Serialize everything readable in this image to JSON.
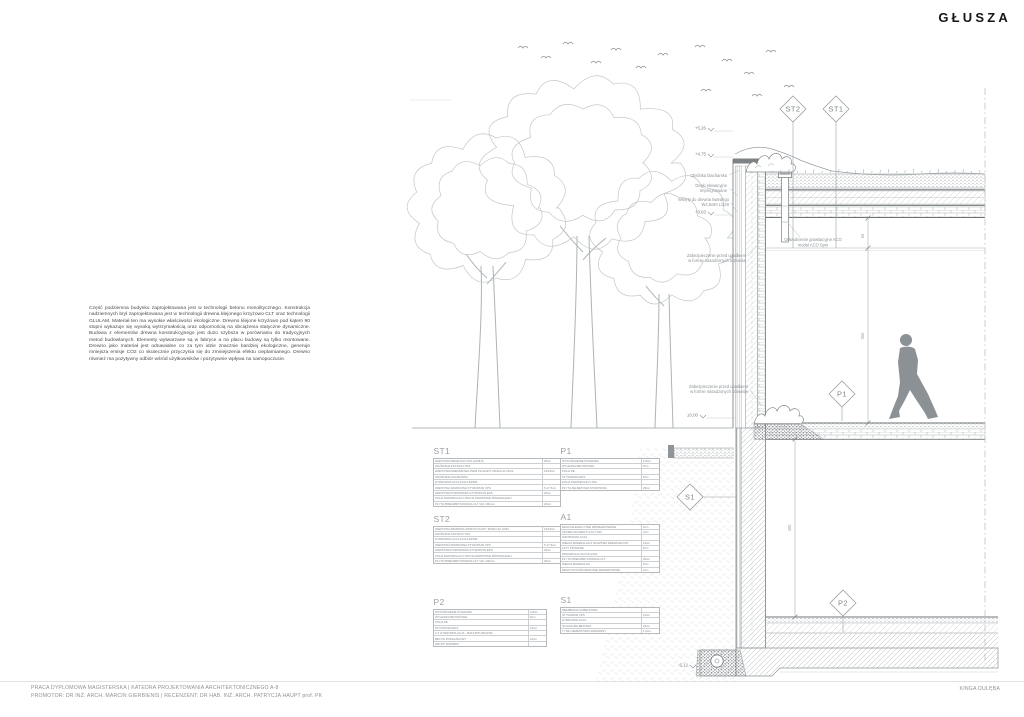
{
  "logo": "GŁUSZA",
  "author": "KINGA DULĘBA",
  "footer": {
    "line1": "PRACA DYPLOMOWA MAGISTERSKA | KATEDRA PROJEKTOWANIA ARCHITEKTONICZNEGO A-8",
    "line2": "PROMOTOR: DR INŻ. ARCH. MARCIN GIERBIENIS | RECENZENT: DR HAB. INŻ. ARCH. PATRYCJA HAUPT prof. PK"
  },
  "description": "Część podziemna budynku zaprojektowana jest w technologii betonu monolitycznego. Konstrukcja nadziemnych brył zaprojektowana jest w technologii drewna klejonego krzyżowo CLT oraz technologii GLULAM. Materiał ten ma wysokie właściwości ekologiczne. Drewno klejone krzyżowo pod kątem 90 stopni wykazuje się wysoką wytrzymałością oraz odpornością na obciążenia statyczne dynamiczne. Budowa z elementów drewna konstrukcyjnego jest dużo szybsza w porównaniu do tradycyjnych metod budowlanych. Elementy wytwarzane są w fabryce a na placu budowy są tylko montowane. Drewno jako materiał jest odnawialne co za tym idzie znacznie bardziej ekologiczne, generuje mniejsza emisje CO2 co skutecznie przyczynia się do zmniejszenia efektu cieplarnianego. Drewno również ma pozytywny odbiór wśród użytkowników i pozytywnie wpływa na samopoczucie.",
  "markers": {
    "st2": "ST2",
    "st1": "ST1",
    "p1": "P1",
    "s1": "S1",
    "p2": "P2"
  },
  "levels": {
    "top": "+5,26",
    "parapet": "+4,75",
    "roof": "+3,63",
    "ground": "±0,00",
    "foundation": "-5,12"
  },
  "dims": {
    "roof_gap": "60",
    "storey": "350",
    "basement": "400"
  },
  "annotations": {
    "flashing": "Obróbka blacharska",
    "boards1": "Deski elewacyjne",
    "boards2": "impregnowane",
    "screws1": "Wkręty do drewna twardego",
    "screws2": "W4,5x60 L/220",
    "shrubs1a": "Zabezpieczenie przed upadkiem",
    "shrubs1b": "w formie nasadzonych krzewów",
    "shrubs2a": "Zabezpieczenie przed upadkiem",
    "shrubs2b": "w formie nasadzonych krzewów",
    "drain1": "Odwodnienie grawitacyjne ACO",
    "drain2": "model ACO Spin"
  },
  "tables": {
    "st1": {
      "title": "ST1",
      "rows": [
        {
          "n": "WARSTWA WEGETACYJNA HUMUS",
          "v": "20cm"
        },
        {
          "n": "WŁÓKNINA FILTRACYJNA",
          "v": ""
        },
        {
          "n": "WARSTWA DRENAŻOWA ŻWIR PŁUKANY FRAKCJA 16/32",
          "v": "10/15cm"
        },
        {
          "n": "WŁÓKNINA OCHRONNA",
          "v": ""
        },
        {
          "n": "HYDROIZOLACJA FOLIA EPDM",
          "v": ""
        },
        {
          "n": "WARSTWA SPADKOWA STYROPIAN XPS",
          "v": "5-17,5cm"
        },
        {
          "n": "WARSTWA POZIOMOWA STYROPIAN EPS",
          "v": "20cm"
        },
        {
          "n": "FOLIA PAROIZOLACYJNA NA WARSTWIE RÓWNAJĄCEJ",
          "v": ""
        },
        {
          "n": "PŁYTA PREFABRYKOWANA CLT GR. 200mm",
          "v": "20cm"
        }
      ]
    },
    "st2": {
      "title": "ST2",
      "rows": [
        {
          "n": "WARSTWA ŻWIROWA ŻWIR PŁUKANY FRAKCJA 16/32",
          "v": "10/15cm"
        },
        {
          "n": "WŁÓKNINA FILTRACYJNA",
          "v": ""
        },
        {
          "n": "HYDROIZOLACJA FOLIA EPDM",
          "v": ""
        },
        {
          "n": "WARSTWA SPADKOWA STYROPIAN XPS",
          "v": "5-17,5cm"
        },
        {
          "n": "WARSTWA POZIOMOWA STYROPIAN EPS",
          "v": "20cm"
        },
        {
          "n": "FOLIA PAROIZOLACYJNA NA WARSTWIE RÓWNAJĄCEJ",
          "v": ""
        },
        {
          "n": "PŁYTA PREFABRYKOWANA CLT GR. 200mm",
          "v": "20cm"
        }
      ]
    },
    "p2": {
      "title": "P2",
      "rows": [
        {
          "n": "WYKOŃCZENIE POSADZKI",
          "v": "2,5cm"
        },
        {
          "n": "WYLEWKA BETONOWA",
          "v": "5cm"
        },
        {
          "n": "FOLIA PE",
          "v": ""
        },
        {
          "n": "STYROPIAN EPS",
          "v": "10cm"
        },
        {
          "n": "2 X HYDROIZOLACJA - MATA BITUMICZNA",
          "v": ""
        },
        {
          "n": "BETON PODKŁADOWY",
          "v": "10cm"
        },
        {
          "n": "GRUNT RODZIMY",
          "v": ""
        }
      ]
    },
    "p1": {
      "title": "P1",
      "rows": [
        {
          "n": "WYKOŃCZENIE POSADZKI",
          "v": "2,5cm"
        },
        {
          "n": "WYLEWKA BETONOWA",
          "v": "5cm"
        },
        {
          "n": "FOLIA PE",
          "v": ""
        },
        {
          "n": "STYROPIAN EPS",
          "v": "5cm"
        },
        {
          "n": "FOLIA PAROIZOLACYJNA",
          "v": ""
        },
        {
          "n": "PŁYTA ŻELBETOWA STROPOWA",
          "v": "25cm"
        }
      ]
    },
    "a1": {
      "title": "A1",
      "rows": [
        {
          "n": "DESKI ELEWACYJNE IMPREGNOWANE",
          "v": "2cm"
        },
        {
          "n": "SZCZELINA WENTYLACYJNA",
          "v": "4cm"
        },
        {
          "n": "WIATROIZOLACJA",
          "v": ""
        },
        {
          "n": "WEŁNA MINERALNA Z RUSZTEM DREWNIANYM",
          "v": "16cm"
        },
        {
          "n": "ŁATY PIONOWE",
          "v": "5cm"
        },
        {
          "n": "PAROIZOLACJA FOLIA PE",
          "v": ""
        },
        {
          "n": "PŁYTA PREFABRYKOWANA CLT",
          "v": "20cm"
        },
        {
          "n": "WEŁNA MINERALNA",
          "v": "5cm"
        },
        {
          "n": "DESKI WYKOŃCZENIOWE WEWNĘTRZNE",
          "v": "2cm"
        }
      ]
    },
    "s1": {
      "title": "S1",
      "rows": [
        {
          "n": "MEMBRANA KUBEŁKOWA",
          "v": ""
        },
        {
          "n": "STYRODUR XPS",
          "v": "10cm"
        },
        {
          "n": "HYDROIZOLACJA",
          "v": ""
        },
        {
          "n": "ŚCIANA ŻELBETOWA",
          "v": "25cm"
        },
        {
          "n": "TYNK CEMENTOWO-WAPIENNY",
          "v": "1,5cm"
        }
      ]
    }
  }
}
